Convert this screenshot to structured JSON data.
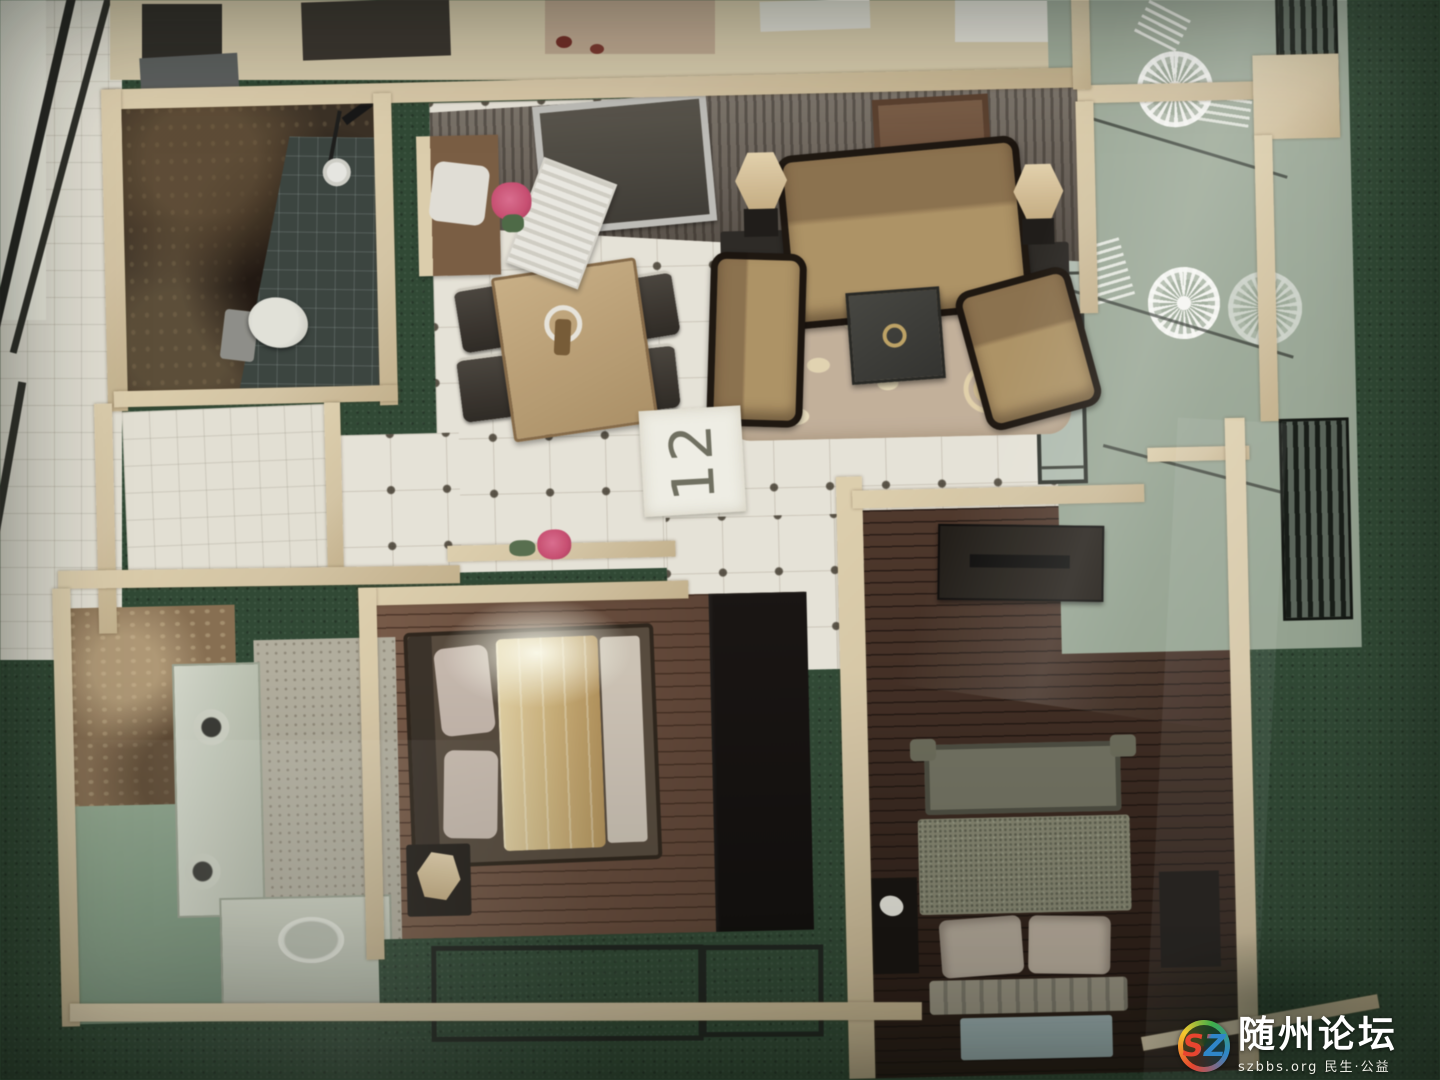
{
  "placard": {
    "number": "12"
  },
  "watermark": {
    "logo_text": "SZ",
    "site_name": "随州论坛",
    "site_url": "szbbs.org",
    "tagline": "民生·公益"
  },
  "palette": {
    "wall_cream": "#d8c6a0",
    "turf_green": "#2c4831",
    "tile_floor": "#e9e5d8",
    "wood_floor": "#6b4936",
    "dark_wood_floor": "#42291d",
    "sofa_tan": "#b2935f",
    "lamp_cream": "#c9ad7c",
    "accent_pink": "#d64a72",
    "logo_red": "#e8452f",
    "logo_blue": "#2f86c8",
    "logo_green": "#3fae49",
    "logo_yellow": "#f4c92e",
    "watermark_white": "#ffffff"
  }
}
